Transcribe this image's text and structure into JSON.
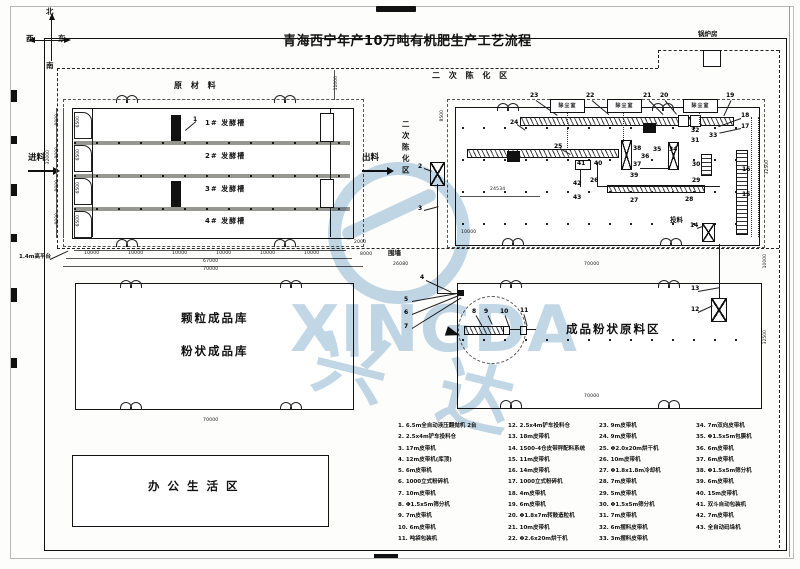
{
  "title": "青海西宁年产10万吨有机肥生产工艺流程",
  "compass": {
    "north": "北",
    "south": "南",
    "east": "东",
    "west": "西"
  },
  "dust": {
    "label": "除尘室"
  },
  "watermark": {
    "latin": "XINGDA",
    "cjk": "兴 达"
  },
  "colors": {
    "line": "#1a1a1a",
    "tank_wall_gray": "#979792",
    "watermark_blue": "#a9c7dd"
  },
  "areas": [
    {
      "t": "原 材 料",
      "x": 174,
      "y": 82,
      "cls": "area-sm",
      "name": "label-raw-material"
    },
    {
      "t": "二 次 陈 化 区",
      "x": 432,
      "y": 72,
      "cls": "area-sm",
      "name": "label-secondary-aging"
    },
    {
      "t": "二次陈化区",
      "x": 398,
      "y": 120,
      "cls": "area-vert",
      "name": "label-secondary-aging-vertical"
    },
    {
      "t": "颗粒成品库",
      "x": 181,
      "y": 313,
      "cls": "area-lg",
      "name": "label-granule-warehouse"
    },
    {
      "t": "粉状成品库",
      "x": 181,
      "y": 346,
      "cls": "area-lg",
      "name": "label-powder-warehouse"
    },
    {
      "t": "成品粉状原料区",
      "x": 566,
      "y": 324,
      "cls": "area-lg",
      "name": "label-powder-raw-area"
    },
    {
      "t": "办 公 生 活 区",
      "x": 148,
      "y": 481,
      "cls": "area-lg",
      "name": "label-office-area"
    },
    {
      "t": "锅炉房",
      "x": 698,
      "y": 31,
      "cls": "area-xs",
      "name": "label-boiler-room"
    },
    {
      "t": "投料",
      "x": 670,
      "y": 217,
      "cls": "area-xs",
      "name": "label-feeding"
    },
    {
      "t": "围墙",
      "x": 388,
      "y": 250,
      "cls": "area-xs",
      "name": "label-fence"
    },
    {
      "t": "1.4m高平台",
      "x": 19,
      "y": 255,
      "cls": "area-xxs",
      "name": "label-platform"
    },
    {
      "t": "进料",
      "x": 28,
      "y": 154,
      "cls": "area-sm2",
      "name": "label-feed-in"
    },
    {
      "t": "出料",
      "x": 362,
      "y": 154,
      "cls": "area-sm2",
      "name": "label-discharge"
    }
  ],
  "tanks": [
    {
      "t": "1# 发酵槽",
      "x": 205,
      "y": 120,
      "cls": "tank"
    },
    {
      "t": "2# 发酵槽",
      "x": 205,
      "y": 153,
      "cls": "tank"
    },
    {
      "t": "3# 发酵槽",
      "x": 205,
      "y": 186,
      "cls": "tank"
    },
    {
      "t": "4# 发酵槽",
      "x": 205,
      "y": 218,
      "cls": "tank"
    }
  ],
  "callouts": [
    {
      "t": "1",
      "x": 193,
      "y": 117
    },
    {
      "t": "2",
      "x": 418,
      "y": 164
    },
    {
      "t": "3",
      "x": 418,
      "y": 206
    },
    {
      "t": "4",
      "x": 420,
      "y": 275
    },
    {
      "t": "5",
      "x": 404,
      "y": 297
    },
    {
      "t": "6",
      "x": 404,
      "y": 310
    },
    {
      "t": "7",
      "x": 404,
      "y": 324
    },
    {
      "t": "8",
      "x": 472,
      "y": 309
    },
    {
      "t": "9",
      "x": 484,
      "y": 309
    },
    {
      "t": "10",
      "x": 500,
      "y": 309
    },
    {
      "t": "11",
      "x": 520,
      "y": 308
    },
    {
      "t": "12",
      "x": 691,
      "y": 307
    },
    {
      "t": "13",
      "x": 691,
      "y": 286
    },
    {
      "t": "14",
      "x": 690,
      "y": 223
    },
    {
      "t": "15",
      "x": 742,
      "y": 192
    },
    {
      "t": "16",
      "x": 742,
      "y": 167
    },
    {
      "t": "17",
      "x": 741,
      "y": 124
    },
    {
      "t": "18",
      "x": 741,
      "y": 113
    },
    {
      "t": "19",
      "x": 726,
      "y": 93
    },
    {
      "t": "20",
      "x": 660,
      "y": 93
    },
    {
      "t": "21",
      "x": 643,
      "y": 93
    },
    {
      "t": "22",
      "x": 586,
      "y": 93
    },
    {
      "t": "23",
      "x": 530,
      "y": 93
    },
    {
      "t": "24",
      "x": 510,
      "y": 120
    },
    {
      "t": "25",
      "x": 554,
      "y": 144
    },
    {
      "t": "26",
      "x": 590,
      "y": 178
    },
    {
      "t": "27",
      "x": 630,
      "y": 198
    },
    {
      "t": "28",
      "x": 685,
      "y": 197
    },
    {
      "t": "29",
      "x": 692,
      "y": 178
    },
    {
      "t": "30",
      "x": 692,
      "y": 162
    },
    {
      "t": "31",
      "x": 691,
      "y": 138
    },
    {
      "t": "32",
      "x": 691,
      "y": 128
    },
    {
      "t": "33",
      "x": 709,
      "y": 133
    },
    {
      "t": "34",
      "x": 669,
      "y": 147
    },
    {
      "t": "35",
      "x": 653,
      "y": 147
    },
    {
      "t": "36",
      "x": 641,
      "y": 154
    },
    {
      "t": "37",
      "x": 633,
      "y": 162
    },
    {
      "t": "38",
      "x": 633,
      "y": 146
    },
    {
      "t": "39",
      "x": 630,
      "y": 173
    },
    {
      "t": "40",
      "x": 594,
      "y": 161
    },
    {
      "t": "41",
      "x": 577,
      "y": 161
    },
    {
      "t": "42",
      "x": 573,
      "y": 181
    },
    {
      "t": "43",
      "x": 573,
      "y": 195
    }
  ],
  "dims": [
    {
      "t": "10000",
      "x": 84,
      "y": 252,
      "cls": "dim"
    },
    {
      "t": "10000",
      "x": 128,
      "y": 252,
      "cls": "dim"
    },
    {
      "t": "10000",
      "x": 172,
      "y": 252,
      "cls": "dim"
    },
    {
      "t": "10000",
      "x": 216,
      "y": 252,
      "cls": "dim"
    },
    {
      "t": "10000",
      "x": 260,
      "y": 252,
      "cls": "dim"
    },
    {
      "t": "10000",
      "x": 304,
      "y": 252,
      "cls": "dim"
    },
    {
      "t": "67000",
      "x": 203,
      "y": 260,
      "cls": "dim"
    },
    {
      "t": "70000",
      "x": 203,
      "y": 268,
      "cls": "dim"
    },
    {
      "t": "2000",
      "x": 354,
      "y": 241,
      "cls": "dim"
    },
    {
      "t": "8000",
      "x": 360,
      "y": 253,
      "cls": "dim"
    },
    {
      "t": "26080",
      "x": 393,
      "y": 263,
      "cls": "dim"
    },
    {
      "t": "70000",
      "x": 584,
      "y": 263,
      "cls": "dim"
    },
    {
      "t": "70000",
      "x": 584,
      "y": 395,
      "cls": "dim"
    },
    {
      "t": "70000",
      "x": 203,
      "y": 419,
      "cls": "dim"
    },
    {
      "t": "24534",
      "x": 490,
      "y": 188,
      "cls": "dim"
    },
    {
      "t": "10000",
      "x": 461,
      "y": 231,
      "cls": "dim"
    },
    {
      "t": "8000",
      "x": 56,
      "y": 114,
      "cls": "vdim"
    },
    {
      "t": "8000",
      "x": 56,
      "y": 147,
      "cls": "vdim"
    },
    {
      "t": "8000",
      "x": 56,
      "y": 180,
      "cls": "vdim"
    },
    {
      "t": "8000",
      "x": 56,
      "y": 213,
      "cls": "vdim"
    },
    {
      "t": "6500",
      "x": 77,
      "y": 116,
      "cls": "vdim"
    },
    {
      "t": "6500",
      "x": 77,
      "y": 149,
      "cls": "vdim"
    },
    {
      "t": "6500",
      "x": 77,
      "y": 182,
      "cls": "vdim"
    },
    {
      "t": "6500",
      "x": 77,
      "y": 215,
      "cls": "vdim"
    },
    {
      "t": "32000",
      "x": 47,
      "y": 150,
      "cls": "vdim"
    },
    {
      "t": "11000",
      "x": 335,
      "y": 76,
      "cls": "vdim"
    },
    {
      "t": "8500",
      "x": 441,
      "y": 110,
      "cls": "vdim"
    },
    {
      "t": "10000",
      "x": 764,
      "y": 254,
      "cls": "vdim"
    },
    {
      "t": "32500",
      "x": 764,
      "y": 330,
      "cls": "vdim"
    },
    {
      "t": "32500",
      "x": 766,
      "y": 160,
      "cls": "vdim"
    }
  ],
  "legend": {
    "col1": [
      "1. 6.5m全自动液压翻抛机 2台",
      "2. 2.5x4m铲车投料仓",
      "3. 17m皮带机",
      "4. 12m皮带机(库顶)",
      "5. 6m皮带机",
      "6. 1000立式粉碎机",
      "7. 10m皮带机",
      "8. Φ1.5x5m筛分机",
      "9. 7m皮带机",
      "10. 6m皮带机",
      "11. 吨袋包装机"
    ],
    "col2": [
      "12. 2.5x4m铲车投料仓",
      "13. 18m皮带机",
      "14. 1500-4仓皮带秤配料系统",
      "15. 11m皮带机",
      "16. 14m皮带机",
      "17. 1000立式粉碎机",
      "18. 4m皮带机",
      "19. 6m皮带机",
      "20. Φ1.8x7m转鼓造粒机",
      "21. 10m皮带机",
      "22. Φ2.6x20m烘干机"
    ],
    "col3": [
      "23. 9m皮带机",
      "24. 9m皮带机",
      "25. Φ2.0x20m烘干机",
      "26. 10m皮带机",
      "27. Φ1.8x1.8m冷却机",
      "28. 7m皮带机",
      "29. 5m皮带机",
      "30. Φ1.5x5m筛分机",
      "31. 7m皮带机",
      "32. 6m摆料皮带机",
      "33. 3m摆料皮带机"
    ],
    "col4": [
      "34. 7m双向皮带机",
      "35. Φ1.5x5m包膜机",
      "36. 6m皮带机",
      "37. 6m皮带机",
      "38. Φ1.5x5m筛分机",
      "39. 6m皮带机",
      "40. 15m皮带机",
      "41. 双斗自动包装机",
      "42. 7m皮带机",
      "43. 全自动码垛机"
    ]
  }
}
